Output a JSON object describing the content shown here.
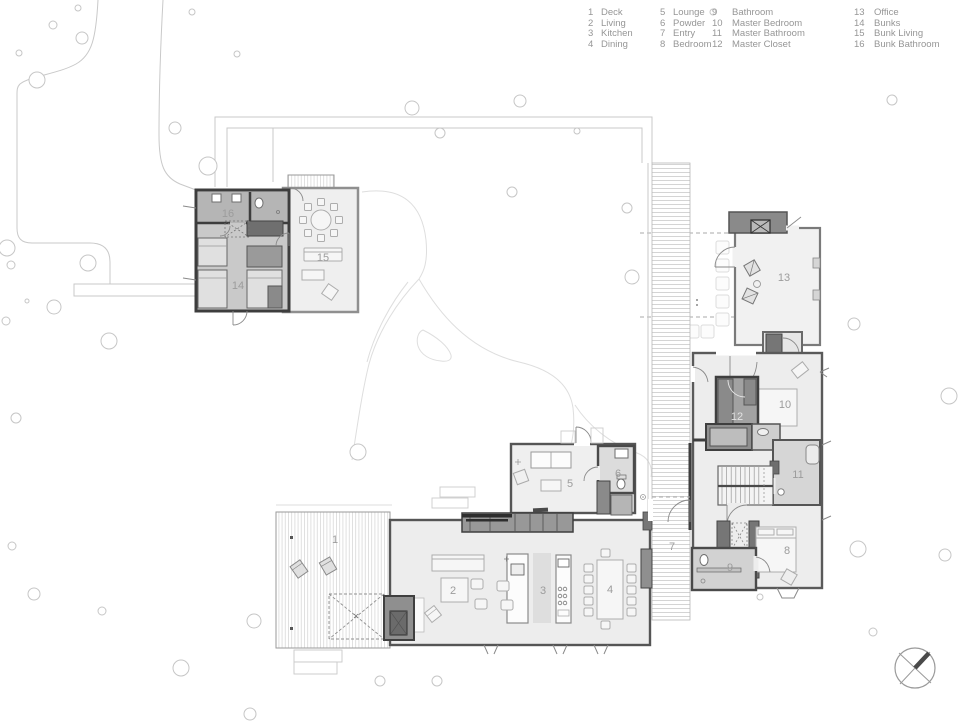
{
  "title": "Residence site / floor plan",
  "rooms": [
    {
      "num": "1",
      "name": "Deck",
      "x": 335,
      "y": 539
    },
    {
      "num": "2",
      "name": "Living",
      "x": 453,
      "y": 590
    },
    {
      "num": "3",
      "name": "Kitchen",
      "x": 543,
      "y": 590
    },
    {
      "num": "4",
      "name": "Dining",
      "x": 610,
      "y": 589
    },
    {
      "num": "5",
      "name": "Lounge",
      "x": 570,
      "y": 483
    },
    {
      "num": "6",
      "name": "Powder",
      "x": 618,
      "y": 473
    },
    {
      "num": "7",
      "name": "Entry",
      "x": 672,
      "y": 546
    },
    {
      "num": "8",
      "name": "Bedroom",
      "x": 787,
      "y": 550
    },
    {
      "num": "9",
      "name": "Bathroom",
      "x": 730,
      "y": 567
    },
    {
      "num": "10",
      "name": "Master Bedroom",
      "x": 785,
      "y": 404
    },
    {
      "num": "11",
      "name": "Master Bathroom",
      "x": 798,
      "y": 474
    },
    {
      "num": "12",
      "name": "Master Closet",
      "x": 737,
      "y": 416,
      "light": true
    },
    {
      "num": "13",
      "name": "Office",
      "x": 784,
      "y": 277
    },
    {
      "num": "14",
      "name": "Bunks",
      "x": 238,
      "y": 285
    },
    {
      "num": "15",
      "name": "Bunk Living",
      "x": 323,
      "y": 257
    },
    {
      "num": "16",
      "name": "Bunk Bathroom",
      "x": 228,
      "y": 213
    }
  ],
  "site": {
    "trees": [
      [
        53,
        25,
        4
      ],
      [
        78,
        8,
        3
      ],
      [
        82,
        38,
        6
      ],
      [
        19,
        53,
        3
      ],
      [
        37,
        80,
        8
      ],
      [
        192,
        12,
        3
      ],
      [
        237,
        54,
        3
      ],
      [
        175,
        128,
        6
      ],
      [
        208,
        166,
        9
      ],
      [
        7,
        248,
        8
      ],
      [
        11,
        265,
        4
      ],
      [
        88,
        263,
        8
      ],
      [
        27,
        301,
        2
      ],
      [
        54,
        307,
        7
      ],
      [
        109,
        341,
        8
      ],
      [
        6,
        321,
        4
      ],
      [
        16,
        418,
        5
      ],
      [
        12,
        546,
        4
      ],
      [
        34,
        594,
        6
      ],
      [
        102,
        611,
        4
      ],
      [
        181,
        668,
        8
      ],
      [
        254,
        621,
        7
      ],
      [
        250,
        714,
        6
      ],
      [
        380,
        681,
        5
      ],
      [
        437,
        681,
        5
      ],
      [
        358,
        452,
        8
      ],
      [
        412,
        108,
        7
      ],
      [
        520,
        101,
        6
      ],
      [
        440,
        133,
        5
      ],
      [
        577,
        131,
        3
      ],
      [
        512,
        192,
        5
      ],
      [
        627,
        208,
        5
      ],
      [
        632,
        277,
        7
      ],
      [
        713,
        12,
        3
      ],
      [
        892,
        100,
        5
      ],
      [
        854,
        324,
        6
      ],
      [
        949,
        396,
        8
      ],
      [
        858,
        549,
        8
      ],
      [
        945,
        555,
        6
      ],
      [
        760,
        597,
        3
      ],
      [
        873,
        632,
        4
      ]
    ],
    "stepping_stones": [
      [
        716,
        241
      ],
      [
        716,
        259
      ],
      [
        716,
        277
      ],
      [
        716,
        295
      ],
      [
        716,
        313
      ],
      [
        701,
        325
      ],
      [
        686,
        325
      ]
    ]
  },
  "north_arrow": {
    "cx": 915,
    "cy": 668,
    "r": 20
  },
  "colors": {
    "legend-text": "#969696",
    "label": "#9c9c9c",
    "site-line": "#c9c9c9",
    "path-line": "#dedede",
    "tree-line": "#c6c6c6",
    "wall-dark": "#3d3d3d",
    "wall": "#555555",
    "room-fill": "#ededed",
    "fill-medium": "#cfcfcf",
    "fill-dark": "#8f8f8f"
  }
}
